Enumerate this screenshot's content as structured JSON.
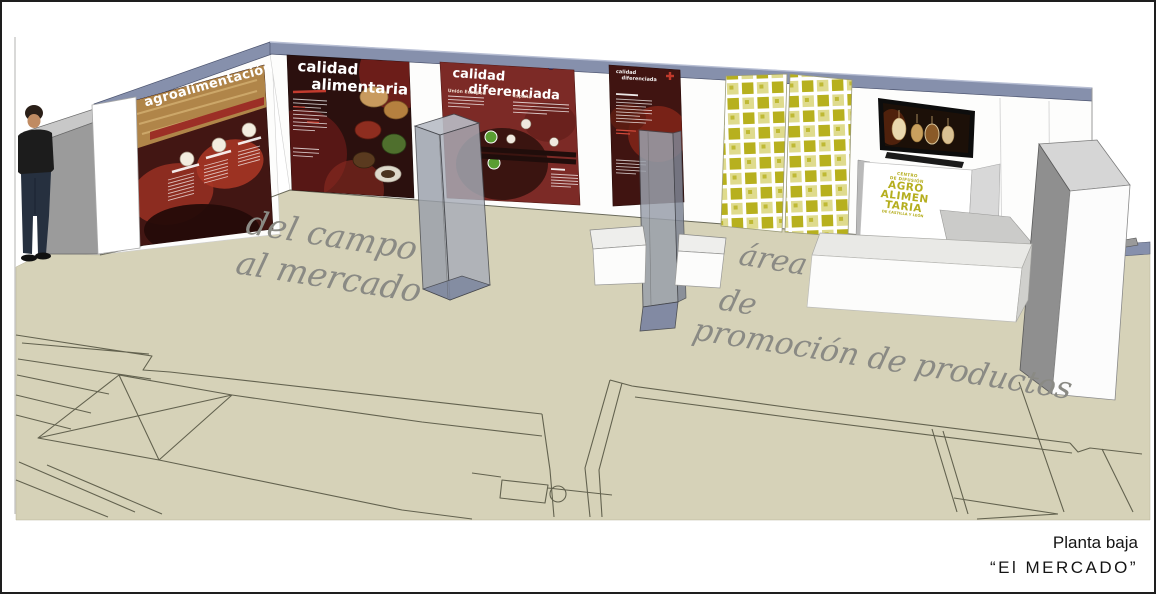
{
  "scene_title": {
    "line1": "Planta baja",
    "line2": "“El MERCADO”"
  },
  "wall_panels": {
    "panel1": {
      "title": "agroalimentación"
    },
    "panel2": {
      "title_line1": "calidad",
      "title_line2": "alimentaria"
    },
    "panel3": {
      "title_line1": "calidad",
      "title_line2": "diferenciada",
      "subheading1": "Unión Europea",
      "subheading2": "España"
    },
    "panel4": {
      "title_line1": "calidad",
      "title_line2": "diferenciada"
    }
  },
  "kiosk_logo": {
    "line1": "CENTRO",
    "line2": "DE DIFUSIÓN",
    "line3": "AGRO",
    "line4": "ALIMEN",
    "line5": "TARIA",
    "line6": "DE CASTILLA Y LEÓN"
  },
  "floor_annotations": {
    "left_line1": "del campo",
    "left_line2": "al mercado",
    "right_line1": "área",
    "right_line2": "de",
    "right_line3": "promoción de productos"
  },
  "colors": {
    "floor": "#d6d2b8",
    "wall_top_band": "#8690ac",
    "panel_maroon": "#7c2a26",
    "panel_dark": "#2b100e",
    "checker_yellow": "#b7b01e",
    "kiosk_text": "#b5ae1e",
    "script_text": "#8a8a84",
    "plan_lines": "#4f4f3d"
  }
}
